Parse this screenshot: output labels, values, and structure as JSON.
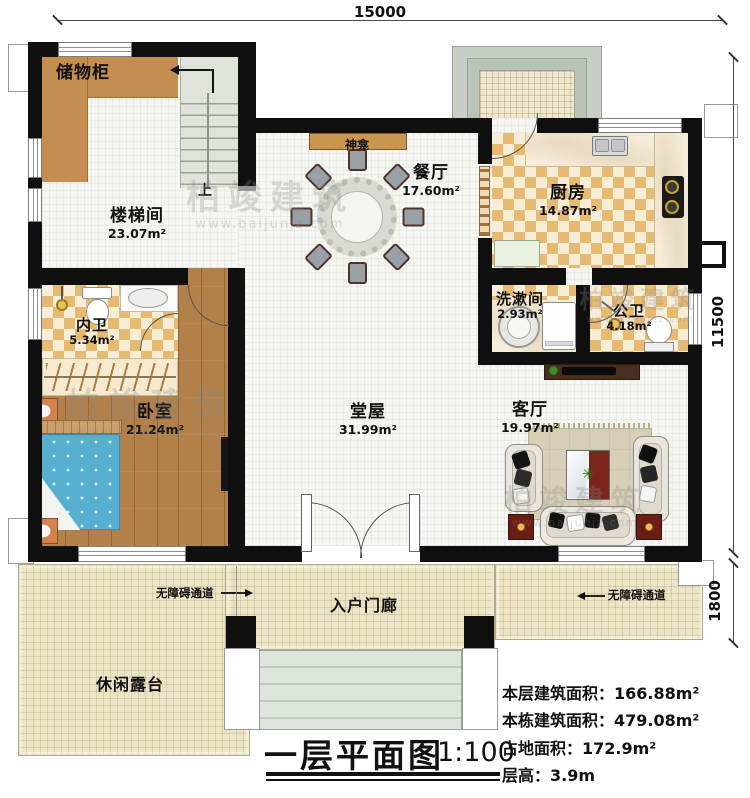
{
  "dimensions": {
    "top": "15000",
    "right": "11500",
    "right_lower": "1800"
  },
  "rooms": {
    "storage": {
      "name": "储物柜"
    },
    "stairwell": {
      "name": "楼梯间",
      "area": "23.07m²"
    },
    "shrine": {
      "name": "神龛"
    },
    "dining": {
      "name": "餐厅",
      "area": "17.60m²"
    },
    "kitchen": {
      "name": "厨房",
      "area": "14.87m²"
    },
    "washroom": {
      "name": "洗漱间",
      "area": "2.93m²"
    },
    "public_bath": {
      "name": "公卫",
      "area": "4.18m²"
    },
    "inner_bath": {
      "name": "内卫",
      "area": "5.34m²"
    },
    "bedroom": {
      "name": "卧室",
      "area": "21.24m²"
    },
    "hall": {
      "name": "堂屋",
      "area": "31.99m²"
    },
    "living": {
      "name": "客厅",
      "area": "19.97m²"
    },
    "porch": {
      "name": "入户门廊"
    },
    "terrace": {
      "name": "休闲露台"
    }
  },
  "labels": {
    "up": "上",
    "accessible_path": "无障碍通道"
  },
  "title": {
    "text": "一层平面图",
    "scale": "1:100"
  },
  "stats": [
    {
      "label": "本层建筑面积：",
      "value": "166.88m²"
    },
    {
      "label": "本栋建筑面积：",
      "value": "479.08m²"
    },
    {
      "label": "占地面积：",
      "value": "172.9m²"
    },
    {
      "label": "层高：",
      "value": "3.9m"
    }
  ],
  "watermark": {
    "name": "柏竣建筑",
    "url": "www.baijunjz.com"
  }
}
